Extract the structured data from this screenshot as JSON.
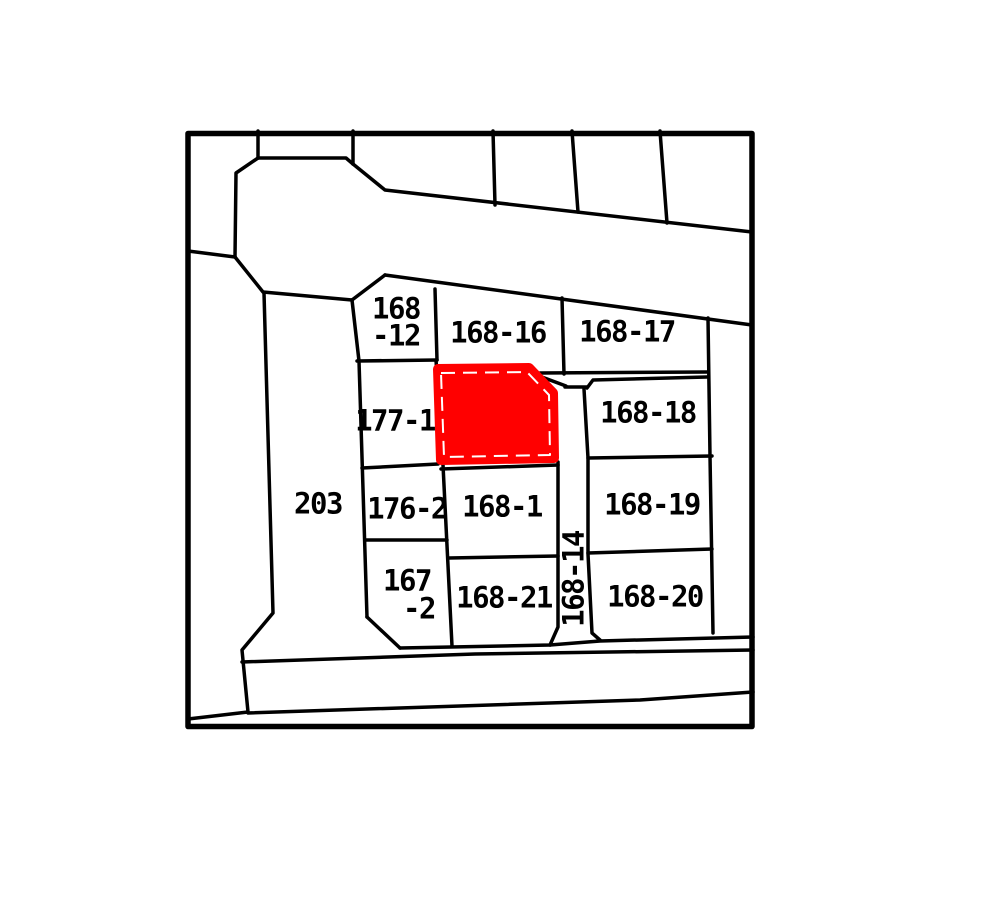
{
  "map": {
    "type": "cadastral-parcel-map",
    "background_color": "#ffffff",
    "line_color": "#000000",
    "highlight_color": "#ff0000",
    "highlight_inner_dash_color": "#ffffff",
    "parcel_numbers": [
      "203",
      "168-12",
      "168-16",
      "168-17",
      "177-1",
      "168-18",
      "176-2",
      "168-1",
      "168-19",
      "167-2",
      "168-21",
      "168-14",
      "168-20"
    ],
    "labels": [
      {
        "text": "168",
        "x": 396,
        "y": 309,
        "rot": 0
      },
      {
        "text": "-12",
        "x": 396,
        "y": 336,
        "rot": 0
      },
      {
        "text": "168-16",
        "x": 498,
        "y": 333,
        "rot": 0
      },
      {
        "text": "168-17",
        "x": 627,
        "y": 332,
        "rot": 0
      },
      {
        "text": "177-1",
        "x": 395,
        "y": 421,
        "rot": 0
      },
      {
        "text": "203",
        "x": 318,
        "y": 504,
        "rot": 0
      },
      {
        "text": "176-2",
        "x": 407,
        "y": 509,
        "rot": 0
      },
      {
        "text": "168-1",
        "x": 502,
        "y": 507,
        "rot": 0
      },
      {
        "text": "168-18",
        "x": 648,
        "y": 413,
        "rot": 0
      },
      {
        "text": "168-19",
        "x": 652,
        "y": 505,
        "rot": 0
      },
      {
        "text": "167",
        "x": 407,
        "y": 581,
        "rot": 0
      },
      {
        "text": "-2",
        "x": 419,
        "y": 609,
        "rot": 0
      },
      {
        "text": "168-21",
        "x": 504,
        "y": 598,
        "rot": 0
      },
      {
        "text": "168-14",
        "x": 574,
        "y": 579,
        "rot": -90
      },
      {
        "text": "168-20",
        "x": 655,
        "y": 597,
        "rot": 0
      }
    ]
  }
}
